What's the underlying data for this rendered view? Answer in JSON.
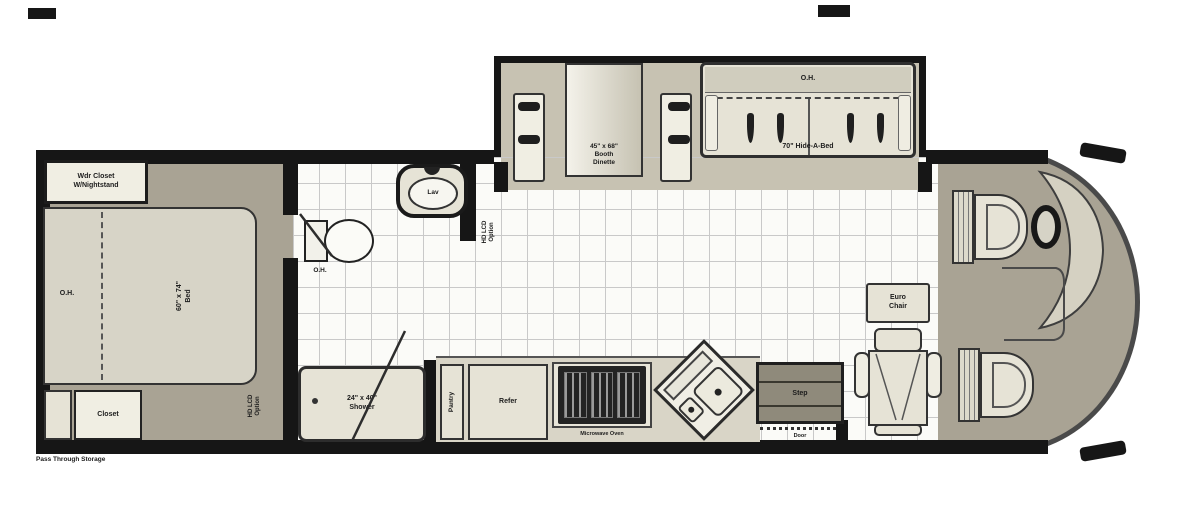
{
  "colors": {
    "wall": "#161616",
    "ink": "#1c1c1c",
    "taupe": "#a9a394",
    "slide": "#c7c2b2",
    "tilebg": "#fbfbf8",
    "tileline": "#c9c9c9",
    "furn": "#e6e3d6",
    "furn2": "#f0eee3",
    "outline": "#333333",
    "range": "#232323",
    "step": "#8f8a7b"
  },
  "plan": {
    "bedroom": {
      "wardrobe": "Wdr Closet\nW/Nightstand",
      "oh": "O.H.",
      "bed": "60\" x 74\"\nBed",
      "closet": "Closet",
      "pass_through": "Pass Through Storage",
      "tv": "HD LCD\nOption"
    },
    "bath": {
      "lav": "Lav",
      "oh": "O.H.",
      "shower": "24\" x 40\"\nShower",
      "tv": "HD LCD\nOption"
    },
    "galley": {
      "pantry": "Pantry",
      "refer": "Refer",
      "microwave": "Microwave Oven",
      "step": "Step",
      "door": "Door"
    },
    "living": {
      "dinette": "45\" x 68\"\nBooth\nDinette",
      "sofa_oh": "O.H.",
      "sofa": "70\" Hide-A-Bed",
      "chair": "Euro\nChair"
    }
  }
}
